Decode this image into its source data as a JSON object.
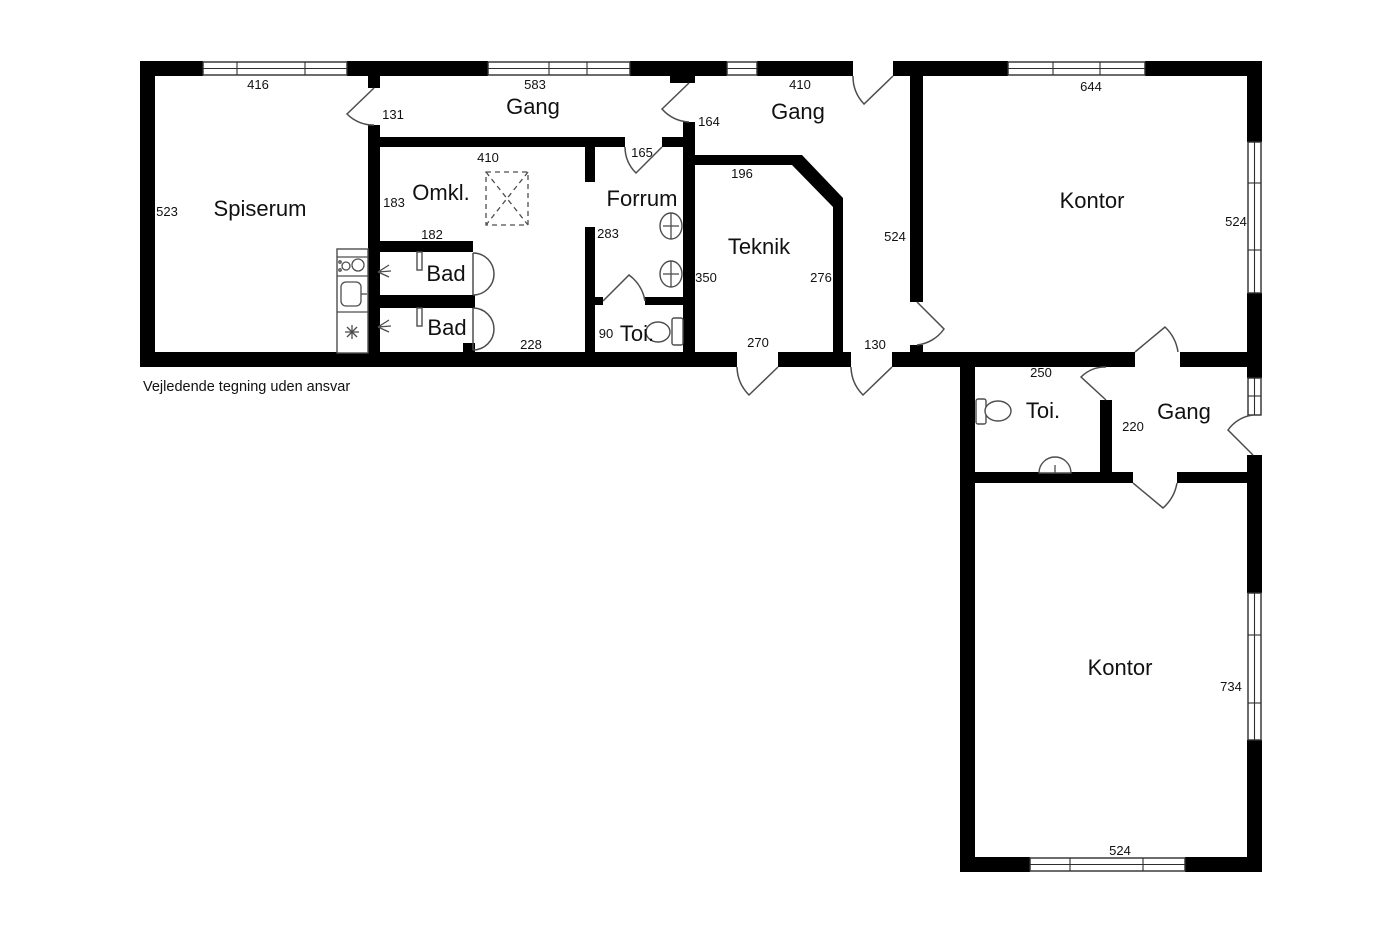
{
  "disclaimer": "Vejledende tegning uden ansvar",
  "colors": {
    "walls": "#000000",
    "background": "#ffffff",
    "fixture_lines": "#4d4d4d"
  },
  "rooms": {
    "spiserum": {
      "label": "Spiserum"
    },
    "gang_top": {
      "label": "Gang"
    },
    "omkl": {
      "label": "Omkl."
    },
    "forrum": {
      "label": "Forrum"
    },
    "teknik": {
      "label": "Teknik"
    },
    "gang_upper_right": {
      "label": "Gang"
    },
    "kontor_top": {
      "label": "Kontor"
    },
    "bad_1": {
      "label": "Bad"
    },
    "bad_2": {
      "label": "Bad"
    },
    "toi_small": {
      "label": "Toi."
    },
    "toi_mid": {
      "label": "Toi."
    },
    "gang_mid": {
      "label": "Gang"
    },
    "kontor_bottom": {
      "label": "Kontor"
    }
  },
  "dimensions": {
    "win_spiserum": "416",
    "win_gang_top": "583",
    "win_gang_upper_right": "410",
    "win_kontor_top": "644",
    "door_spiserum": "131",
    "spiserum_height": "523",
    "omkl_width": "410",
    "omkl_left": "183",
    "door_gang_divider": "164",
    "door_forrum": "165",
    "teknik_top": "196",
    "bad_width": "182",
    "forrum_left": "283",
    "teknik_left": "350",
    "teknik_right": "276",
    "gang_right_height": "524",
    "kontor_top_height": "524",
    "corridor_bottom": "228",
    "toi_small_width": "90",
    "door_teknik_exit": "270",
    "door_gang_exit": "130",
    "toi_mid_width": "250",
    "gang_mid_height": "220",
    "kontor_bottom_height": "734",
    "win_kontor_bottom": "524"
  },
  "fixtures": {
    "names": [
      "stove",
      "kitchen-sink",
      "fridge",
      "shower-head",
      "shower-area-dashed",
      "wall-basin",
      "toilet",
      "hand-basin",
      "door-leaf"
    ]
  }
}
